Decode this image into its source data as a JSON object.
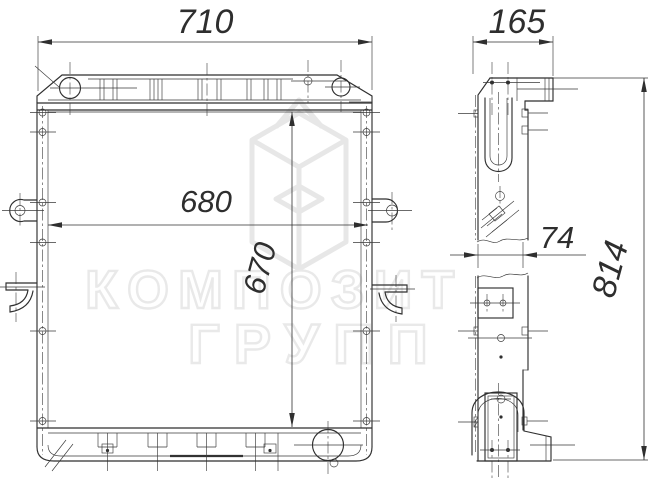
{
  "drawing": {
    "type": "engineering-drawing",
    "subject": "radiator two-view technical drawing",
    "dimensions": {
      "overall_width": "710",
      "depth": "165",
      "core_width": "680",
      "core_height": "670",
      "core_thickness": "74",
      "overall_height": "814"
    },
    "watermark": {
      "line1": "КОМПОЗИТ",
      "line2": "ГРУПП"
    },
    "colors": {
      "line": "#2f2f2f",
      "paper": "#ffffff",
      "watermark": "#e9e9e9"
    }
  }
}
